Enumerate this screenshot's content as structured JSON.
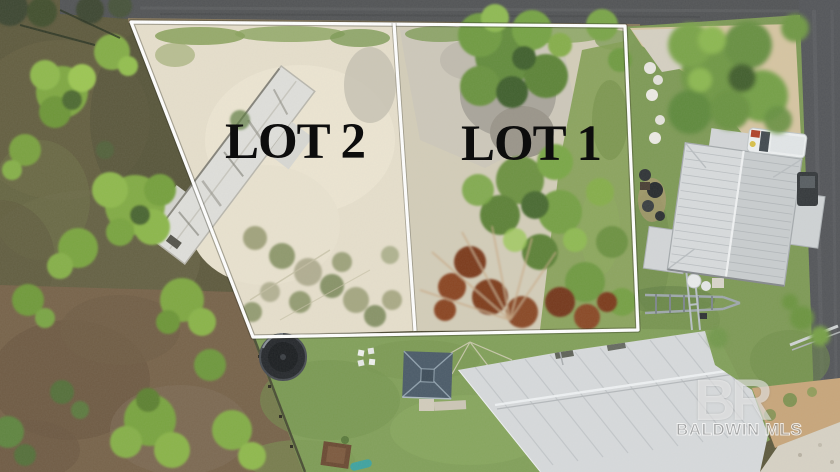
{
  "overlay": {
    "lot_labels": [
      {
        "id": "lot-2",
        "text": "LOT 2"
      },
      {
        "id": "lot-1",
        "text": "LOT 1"
      }
    ]
  },
  "watermark": {
    "logo": "BR",
    "name": "BALDWIN MLS"
  },
  "colors": {
    "boundary_line": "#ffffff",
    "label_text": "#0d0d0d",
    "watermark": "#ffffff",
    "road": "#525456",
    "sand_lot": "#e6dfcc",
    "gravel": "#aba79c",
    "lawn": "#82a05a",
    "pine_tree": "#7fa843",
    "dead_tree": "#7f3d1e",
    "metal_roof": "#d7dadc",
    "gazebo_roof": "#4b5b69",
    "driveway_tan": "#d6c5a2",
    "concrete": "#d7d2c5",
    "woods_ground": "#5e5a3e",
    "dirt": "#77634a"
  }
}
